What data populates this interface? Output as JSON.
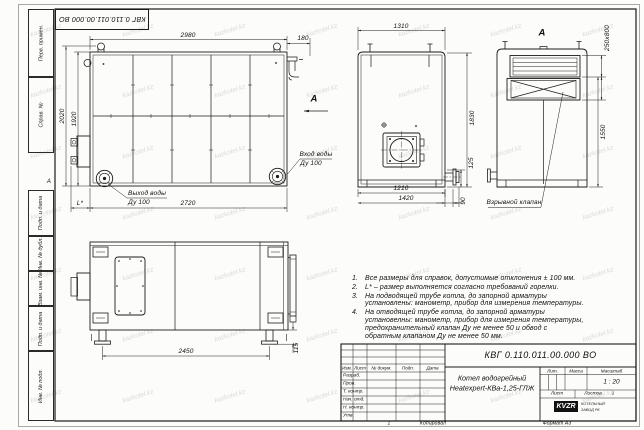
{
  "sheet": {
    "stamp_top_left": "КВГ 0.110.011.00.000 ВО",
    "zone_mark": "А",
    "fold_mark": "1",
    "copied_label": "Копировал",
    "format_label": "Формат А3"
  },
  "margin_labels": {
    "perv_primen": "Перв. примен.",
    "sprav_no": "Справ. №",
    "podp_data_1": "Подп. и дата",
    "inv_dubl": "Инв. № дубл.",
    "vzam_inv": "Взам. инв. №",
    "podp_data_2": "Подп. и дата",
    "inv_podl": "Инв. № подл."
  },
  "views": {
    "plan": {
      "dims": {
        "top_width": "2980",
        "top_right": "180",
        "left_outer": "2020",
        "left_inner": "1920",
        "bottom": "2720",
        "burner": "L*"
      },
      "labels": {
        "outlet_line1": "Выход воды",
        "outlet_line2": "Ду 100",
        "inlet_line1": "Вход воды",
        "inlet_line2": "Ду 100",
        "view_arrow": "А"
      }
    },
    "front": {
      "dims": {
        "top_width": "1310",
        "height": "1830",
        "stub_height": "125",
        "stub_offset": "90",
        "bottom_inner": "1210",
        "bottom_outer": "1420"
      }
    },
    "view_a": {
      "title": "А",
      "dims": {
        "valve_size": "250x800",
        "height": "1550"
      },
      "labels": {
        "explosion_valve": "Взрывной клапан"
      }
    },
    "side": {
      "dims": {
        "leg_span": "2450",
        "foot": "115"
      }
    }
  },
  "notes": {
    "items": [
      {
        "num": "1.",
        "text": "Все размеры для справок, допустимые отклонения ± 100 мм."
      },
      {
        "num": "2.",
        "text": "L* – размер выполняется согласно требований горелки."
      },
      {
        "num": "3.",
        "text": "На подводящей трубе котла, до запорной арматуры установлены: манометр, прибор для измерения температуры."
      },
      {
        "num": "4.",
        "text": "На отводящей трубе котла, до запорной арматуры установелны: манометр, прибор для измерения температуры, предохранительный клапан Ду не менее 50 и обвод с обратным клапаном Ду не менее 50 мм."
      }
    ]
  },
  "title_block": {
    "doc_number": "КВГ 0.110.011.00.000 ВО",
    "product_name_line1": "Котел водогрейный",
    "product_name_line2": "Heatexpert-КВа-1,25-ГЛЖ",
    "columns": {
      "izm": "Изм.",
      "list": "Лист",
      "doc_no": "№ докум.",
      "podp": "Подп.",
      "data": "Дата"
    },
    "rows": [
      "Разраб.",
      "Пров.",
      "Т. контр.",
      "Нач. отд.",
      "Н. контр.",
      "Утв."
    ],
    "lit_label": "Лит.",
    "mass_label": "Масса",
    "scale_label": "Масштаб",
    "scale_value": "1 : 20",
    "sheet_label": "Лист",
    "sheets_label": "Листов",
    "sheets_value": "1",
    "logo_text": "KVZR",
    "company_line1": "КОТЕЛЬНЫЙ",
    "company_line2": "ЗАВОД РК"
  },
  "watermark": {
    "text": "kazkotel.kz"
  }
}
